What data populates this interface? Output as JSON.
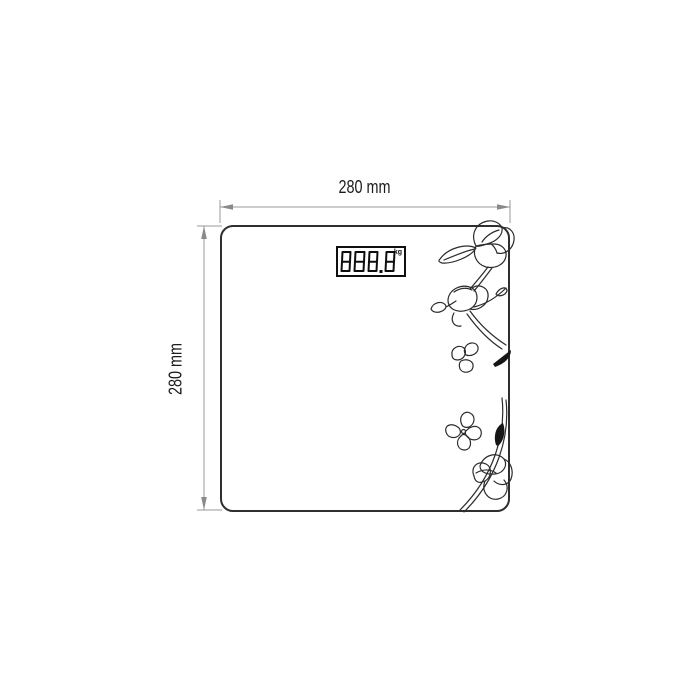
{
  "diagram": {
    "dimensions": {
      "width_label": "280 mm",
      "height_label": "280 mm"
    },
    "display": {
      "value": "888.8",
      "unit": "kg"
    },
    "icons": {
      "decoration": "magnolia-flower-line-art",
      "width_arrows": "horizontal-double-arrow",
      "height_arrows": "vertical-double-arrow"
    },
    "colors": {
      "background": "#ffffff",
      "body_outline": "#2f2f2f",
      "dimension_line": "#9a9a9a",
      "label_text": "#1b1b1b",
      "lcd_border": "#0f0f0f",
      "artwork": "#2b2b2b"
    }
  }
}
